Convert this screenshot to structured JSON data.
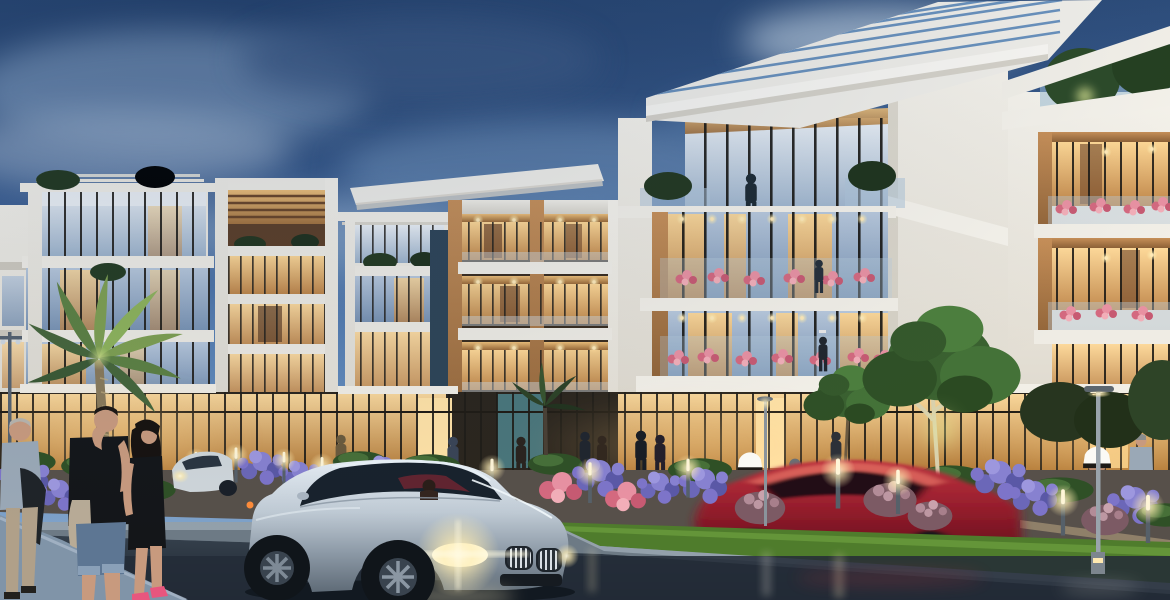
{
  "scene": {
    "title": "Dusk architectural rendering of a modern low-rise residential complex with street, landscaping, pedestrians and a silver coupe",
    "palette": {
      "sky-top": "#2e4e7c",
      "sky-mid": "#4a74ab",
      "sky-low": "#7fa4c9",
      "cloud": "#b9cbdf",
      "bldg-white": "#efece3",
      "bldg-white-shade": "#d6d2c8",
      "wood": "#a8784a",
      "wood-lit": "#d8a35f",
      "win-warm": "#edbe7a",
      "win-cool": "#8ba3c0",
      "glass-teal": "#4e7f86",
      "storefront-glow": "#f6cd8a",
      "grass": "#4f7c2c",
      "hedge": "#2e4a20",
      "tree-green": "#3f6b33",
      "tree-lit": "#9ec26a",
      "flower-purple": "#7d74c9",
      "flower-pink": "#e08795",
      "shrub-mauve": "#96707c",
      "road": "#232c37",
      "road-light": "#3c4854",
      "curb": "#93a0ab",
      "sidewalk": "#8094a8",
      "promenade": "#57504a",
      "car-silver": "#b6c2cd",
      "car-red": "#8e2030",
      "headlight": "#fff6d2",
      "bollard-glow": "#ffe9b0",
      "kandura": "#f2efe6",
      "skin": "#c89a7e",
      "denim": "#5d7693",
      "black-cloth": "#141619",
      "shirt-grey": "#9aa8b6",
      "khaki": "#b0a089"
    },
    "objects": [
      {
        "name": "sky",
        "label": "evening blue sky with clouds"
      },
      {
        "name": "building-a",
        "label": "left apartment block with rooftop pergola and plants"
      },
      {
        "name": "building-b",
        "label": "white-framed block with warm wood pergola"
      },
      {
        "name": "building-c",
        "label": "white block with slatted roof"
      },
      {
        "name": "building-d",
        "label": "wood-framed block with recessed lit balconies"
      },
      {
        "name": "building-e",
        "label": "central tower with large cantilevered pergola roof"
      },
      {
        "name": "building-f",
        "label": "right block with wood balcony boxes and rooftop trees"
      },
      {
        "name": "storefronts",
        "label": "glowing ground-floor retail glazing"
      },
      {
        "name": "palm-tree",
        "label": "up-lit palm tree"
      },
      {
        "name": "street-trees",
        "label": "green street trees with uplights"
      },
      {
        "name": "flower-beds",
        "label": "purple, pink and mauve flowering shrubs"
      },
      {
        "name": "grass-strip",
        "label": "lit lawn verge"
      },
      {
        "name": "road",
        "label": "dark asphalt street with light reflections"
      },
      {
        "name": "silver-coupe",
        "label": "silver coupe with headlights on, driver visible"
      },
      {
        "name": "red-coupe",
        "label": "red coupe in motion blur"
      },
      {
        "name": "white-car",
        "label": "white car in left distance"
      },
      {
        "name": "pedestrian-couple",
        "label": "man in black tee and woman in black dress walking"
      },
      {
        "name": "elderly-man",
        "label": "grey-haired man in pale shirt"
      },
      {
        "name": "kandura-men",
        "label": "two men in white traditional dress"
      },
      {
        "name": "street-lamps",
        "label": "modern flat-top street lamps"
      },
      {
        "name": "bollard-lights",
        "label": "glowing garden bollard lights"
      }
    ]
  }
}
